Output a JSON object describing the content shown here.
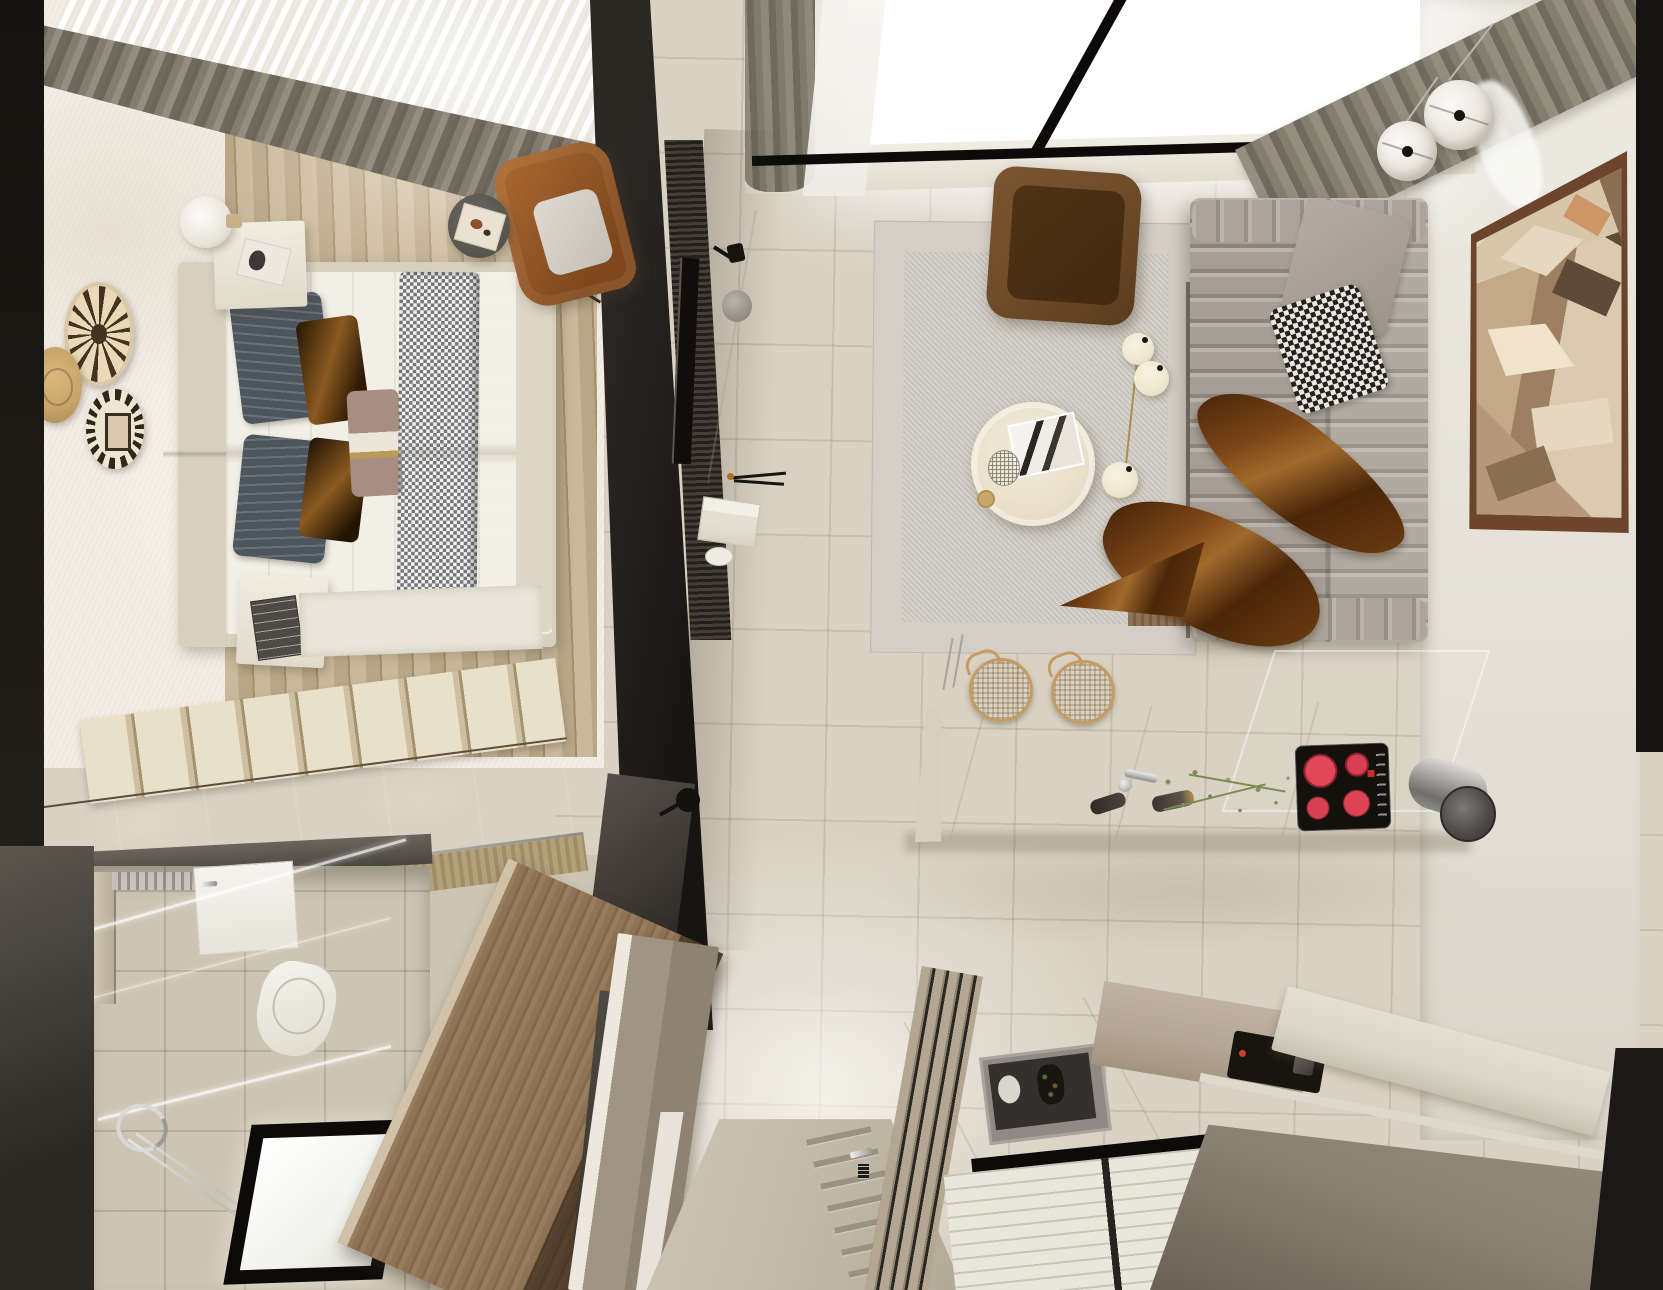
{
  "scene": {
    "title": "Top-down 3D render of a compact studio apartment",
    "view": "top-down interior render",
    "rooms": [
      {
        "name": "bedroom",
        "items": [
          "double-bed",
          "gray-headboard",
          "navy-striped-pillows",
          "satin-brown-pillows",
          "mauve-accent-pillow",
          "gray-checkered-throw",
          "brown-blanket",
          "white-nightstand-with-book",
          "white-nightstand-with-dark-book",
          "round-table-lamp",
          "woven-wall-plates",
          "cognac-wing-armchair",
          "dark-round-side-table",
          "white-rug",
          "slatted-storage-platform",
          "glossy-dark-wardrobe",
          "olive-curtains",
          "sheer-window-light",
          "oak-plank-floor"
        ]
      },
      {
        "name": "bathroom",
        "items": [
          "glass-shower-partition",
          "white-door",
          "mirror-cabinet",
          "toilet",
          "chrome-towel-ring",
          "chrome-towel-bar",
          "illuminated-floor-window",
          "beige-tile-floor"
        ]
      },
      {
        "name": "living-room",
        "items": [
          "channel-tufted-gray-sofa",
          "gray-back-pillow",
          "houndstooth-pillow",
          "satin-brown-throw",
          "brown-leather-lounge-chair",
          "round-travertine-coffee-table",
          "marble-print-magazine",
          "wire-sphere-decor",
          "three-globe-floor-lamp",
          "textured-gray-area-rug",
          "two-globe-pendant-lights",
          "abstract-cubist-wall-art",
          "skylight-window-black-mullions",
          "olive-curtains",
          "media-partition-wall",
          "slatted-media-panel",
          "wall-mounted-tv",
          "marble-media-console",
          "black-wall-sconce",
          "foot-bench"
        ]
      },
      {
        "name": "kitchen",
        "items": [
          "white-marble-island",
          "rattan-bar-stools",
          "chrome-faucet",
          "pepper-grinders",
          "herb-sprigs",
          "induction-cooktop-four-red-burners",
          "cylindrical-chrome-hood",
          "glass-screen",
          "built-in-oven-with-food",
          "marble-counter",
          "taupe-cabinets",
          "compact-black-appliance",
          "white-slatted-window-shutters",
          "entry-door-with-ladder-trim",
          "chrome-door-handle",
          "wood-slat-partition",
          "taupe-sideboard",
          "walnut-console"
        ]
      }
    ]
  },
  "palette": {
    "edgeDark": "#15130f",
    "edgeGray": "#4a453f",
    "bedroomWall": "#efe9df",
    "woodA": "#c9b89b",
    "woodB": "#b9a687",
    "woodLine": "#a18e6c",
    "curtainA": "#948d80",
    "curtainB": "#6f6a5e",
    "curtainC": "#837d70",
    "sheer": "#f7f5f0",
    "windowWhite": "#ffffff",
    "frameBlack": "#0c0b09",
    "tile": "#d9d2c4",
    "tileLine": "#b7ad99",
    "headboard": "#928e86",
    "mattress": "#f2efe7",
    "bedFrame": "#d8d0bf",
    "pillowNavy": "#4d565e",
    "pillowBrownA": "#8a5a20",
    "pillowBrownB": "#241402",
    "pillowMauve": "#a78d82",
    "throwGray": "#70767a",
    "blanketBrown": "#97755c",
    "rugWhite": "#e9e5da",
    "nightstand": "#f0ece1",
    "plateCream": "#ead9b9",
    "plateInk": "#43331f",
    "plateGold": "#c5a368",
    "cognacA": "#ad6a33",
    "cognacB": "#7e481c",
    "sideTableDark": "#57544e",
    "platformWood": "#e5dcc3",
    "platformGap": "#a3946f",
    "wardrobeA": "#4a3c2c",
    "wardrobeB": "#191410",
    "frontWood": "#ad9a74",
    "bathTile": "#cdc5b3",
    "toiletWhite": "#f5f3ed",
    "chrome": "#e8e8e4",
    "chromeDark": "#8f8f89",
    "walnutA": "#8e7355",
    "walnutB": "#5c4731",
    "partitionA": "#2c2925",
    "partitionB": "#171512",
    "slatDark": "#23201c",
    "slatLight": "#453f37",
    "marbleWhite": "#eee9dd",
    "rugA": "#d3cfc7",
    "rugB": "#c6c2ba",
    "sofaA": "#a69e94",
    "sofaB": "#8f877d",
    "houndDark": "#24211d",
    "houndLight": "#ece8df",
    "satinA": "#7a4517",
    "satinB": "#3c1f07",
    "satinC": "#a06a2c",
    "loungeA": "#6d4a29",
    "loungeB": "#4e3315",
    "tableCream": "#eadfc9",
    "lampCream": "#f0e8d2",
    "pendantGlass": "#e9e5dd",
    "wallWhite": "#eae6de",
    "artFrame": "#6d452c",
    "artA": "#d8c6aa",
    "artB": "#b5987a",
    "artC": "#8a6e50",
    "artD": "#5f4a38",
    "artE": "#e6d8c0",
    "islandWhite": "#f2eee4",
    "islandSide": "#d8cfbe",
    "rattanA": "#dcbd92",
    "rattanB": "#c49c63",
    "cooktop": "#14110d",
    "burnerRed": "#d84052",
    "hoodA": "#dcdbd7",
    "hoodB": "#6f6e6a",
    "counterTaupe": "#b3a695",
    "counterWhite": "#dbd6ca",
    "steel": "#8f8b84",
    "ovenDark": "#33312d",
    "shutter": "#e9e6db",
    "doorGreige": "#c3baa9",
    "doorBar": "#9b9280",
    "sideboard": "#a09583",
    "sideboardEdge": "#ece8dd",
    "panelBrown": "#8a8073",
    "plantGreen": "#7e8f57",
    "brass": "#b08d4f"
  }
}
